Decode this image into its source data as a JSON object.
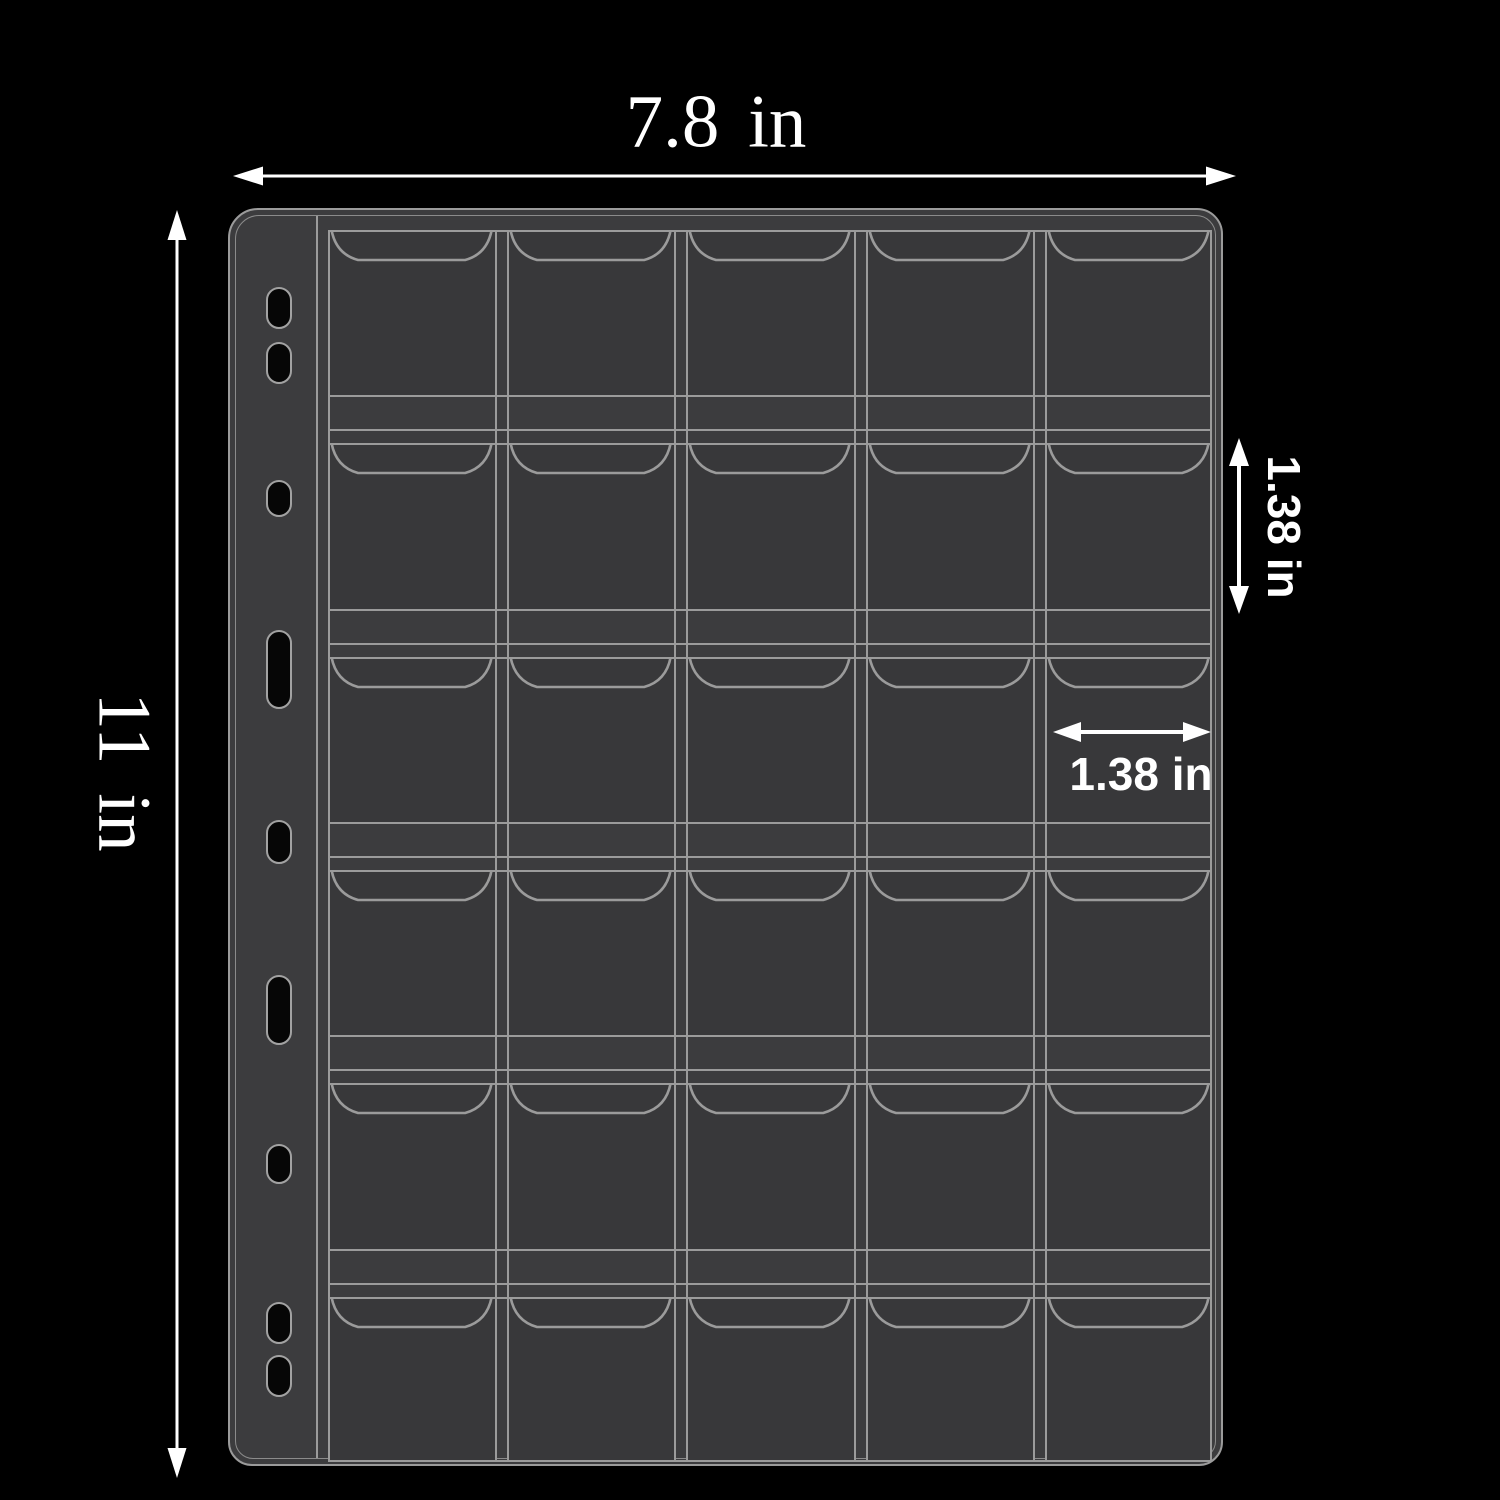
{
  "canvas": {
    "background": "#000000",
    "width": 1500,
    "height": 1500
  },
  "dimension_labels": {
    "page_width": "7.8 in",
    "page_height": "11 in",
    "pocket_height": "1.38 in",
    "pocket_width": "1.38 in"
  },
  "page": {
    "fill": "#3c3c3e",
    "line_color": "#9b9b9b",
    "rows": 6,
    "columns": 5,
    "pocket_count": 30,
    "binder_hole_count": 9,
    "binder_holes": [
      {
        "top": 71,
        "height": 42
      },
      {
        "top": 126,
        "height": 42
      },
      {
        "top": 264,
        "height": 37
      },
      {
        "top": 414,
        "height": 79
      },
      {
        "top": 604,
        "height": 44
      },
      {
        "top": 759,
        "height": 70
      },
      {
        "top": 928,
        "height": 40
      },
      {
        "top": 1086,
        "height": 42
      },
      {
        "top": 1139,
        "height": 42
      }
    ]
  },
  "arrows": {
    "color": "#ffffff"
  }
}
